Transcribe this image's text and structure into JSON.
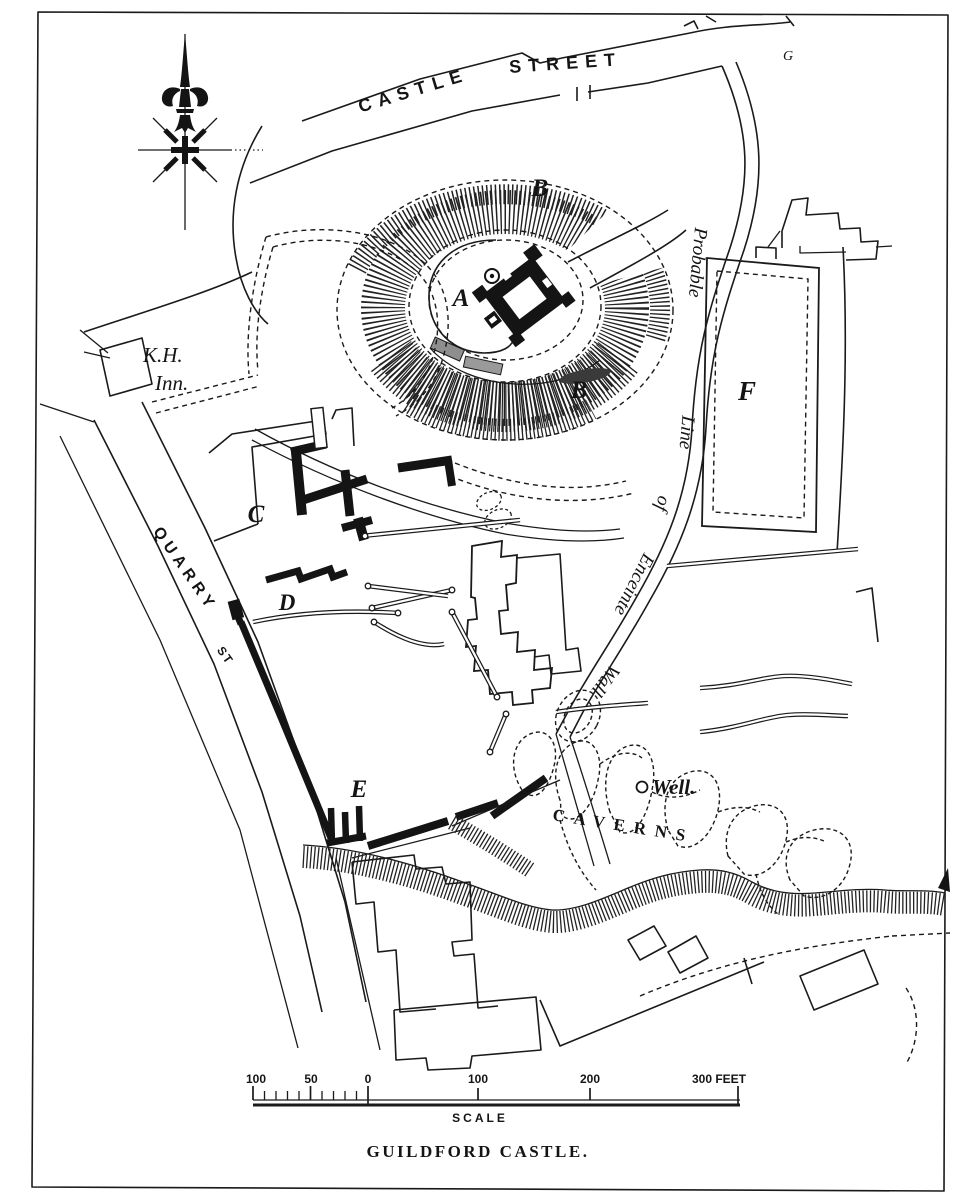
{
  "map": {
    "caption": "GUILDFORD CASTLE.",
    "ink_color": "#1a1a1a",
    "paper_color": "#ffffff"
  },
  "streets": {
    "castle_street_word1": "CASTLE",
    "castle_street_word2": "STREET",
    "quarry_street_word": "QUARRY",
    "quarry_street_abbrev": "ST"
  },
  "site_letters": {
    "keep_a": "A",
    "bailey_b_upper": "B",
    "bailey_b_lower": "B",
    "ruins_c": "C",
    "ruins_d": "D",
    "ruins_e": "E",
    "enclosure_f": "F",
    "corner_g": "G"
  },
  "place_labels": {
    "inn_line1": "K.H.",
    "inn_line2": "Inn.",
    "well": "Well.",
    "caverns": "CAVERNS"
  },
  "enceinte_label": {
    "words": [
      "Probable",
      "Line",
      "of",
      "Enceinte",
      "Wall"
    ]
  },
  "scale_bar": {
    "left_labels": [
      "100",
      "50",
      "0"
    ],
    "right_labels": [
      "100",
      "200"
    ],
    "end_label": "300 FEET",
    "title": "SCALE"
  },
  "icons": {
    "compass": "fleur-de-lis-north-arrow"
  }
}
